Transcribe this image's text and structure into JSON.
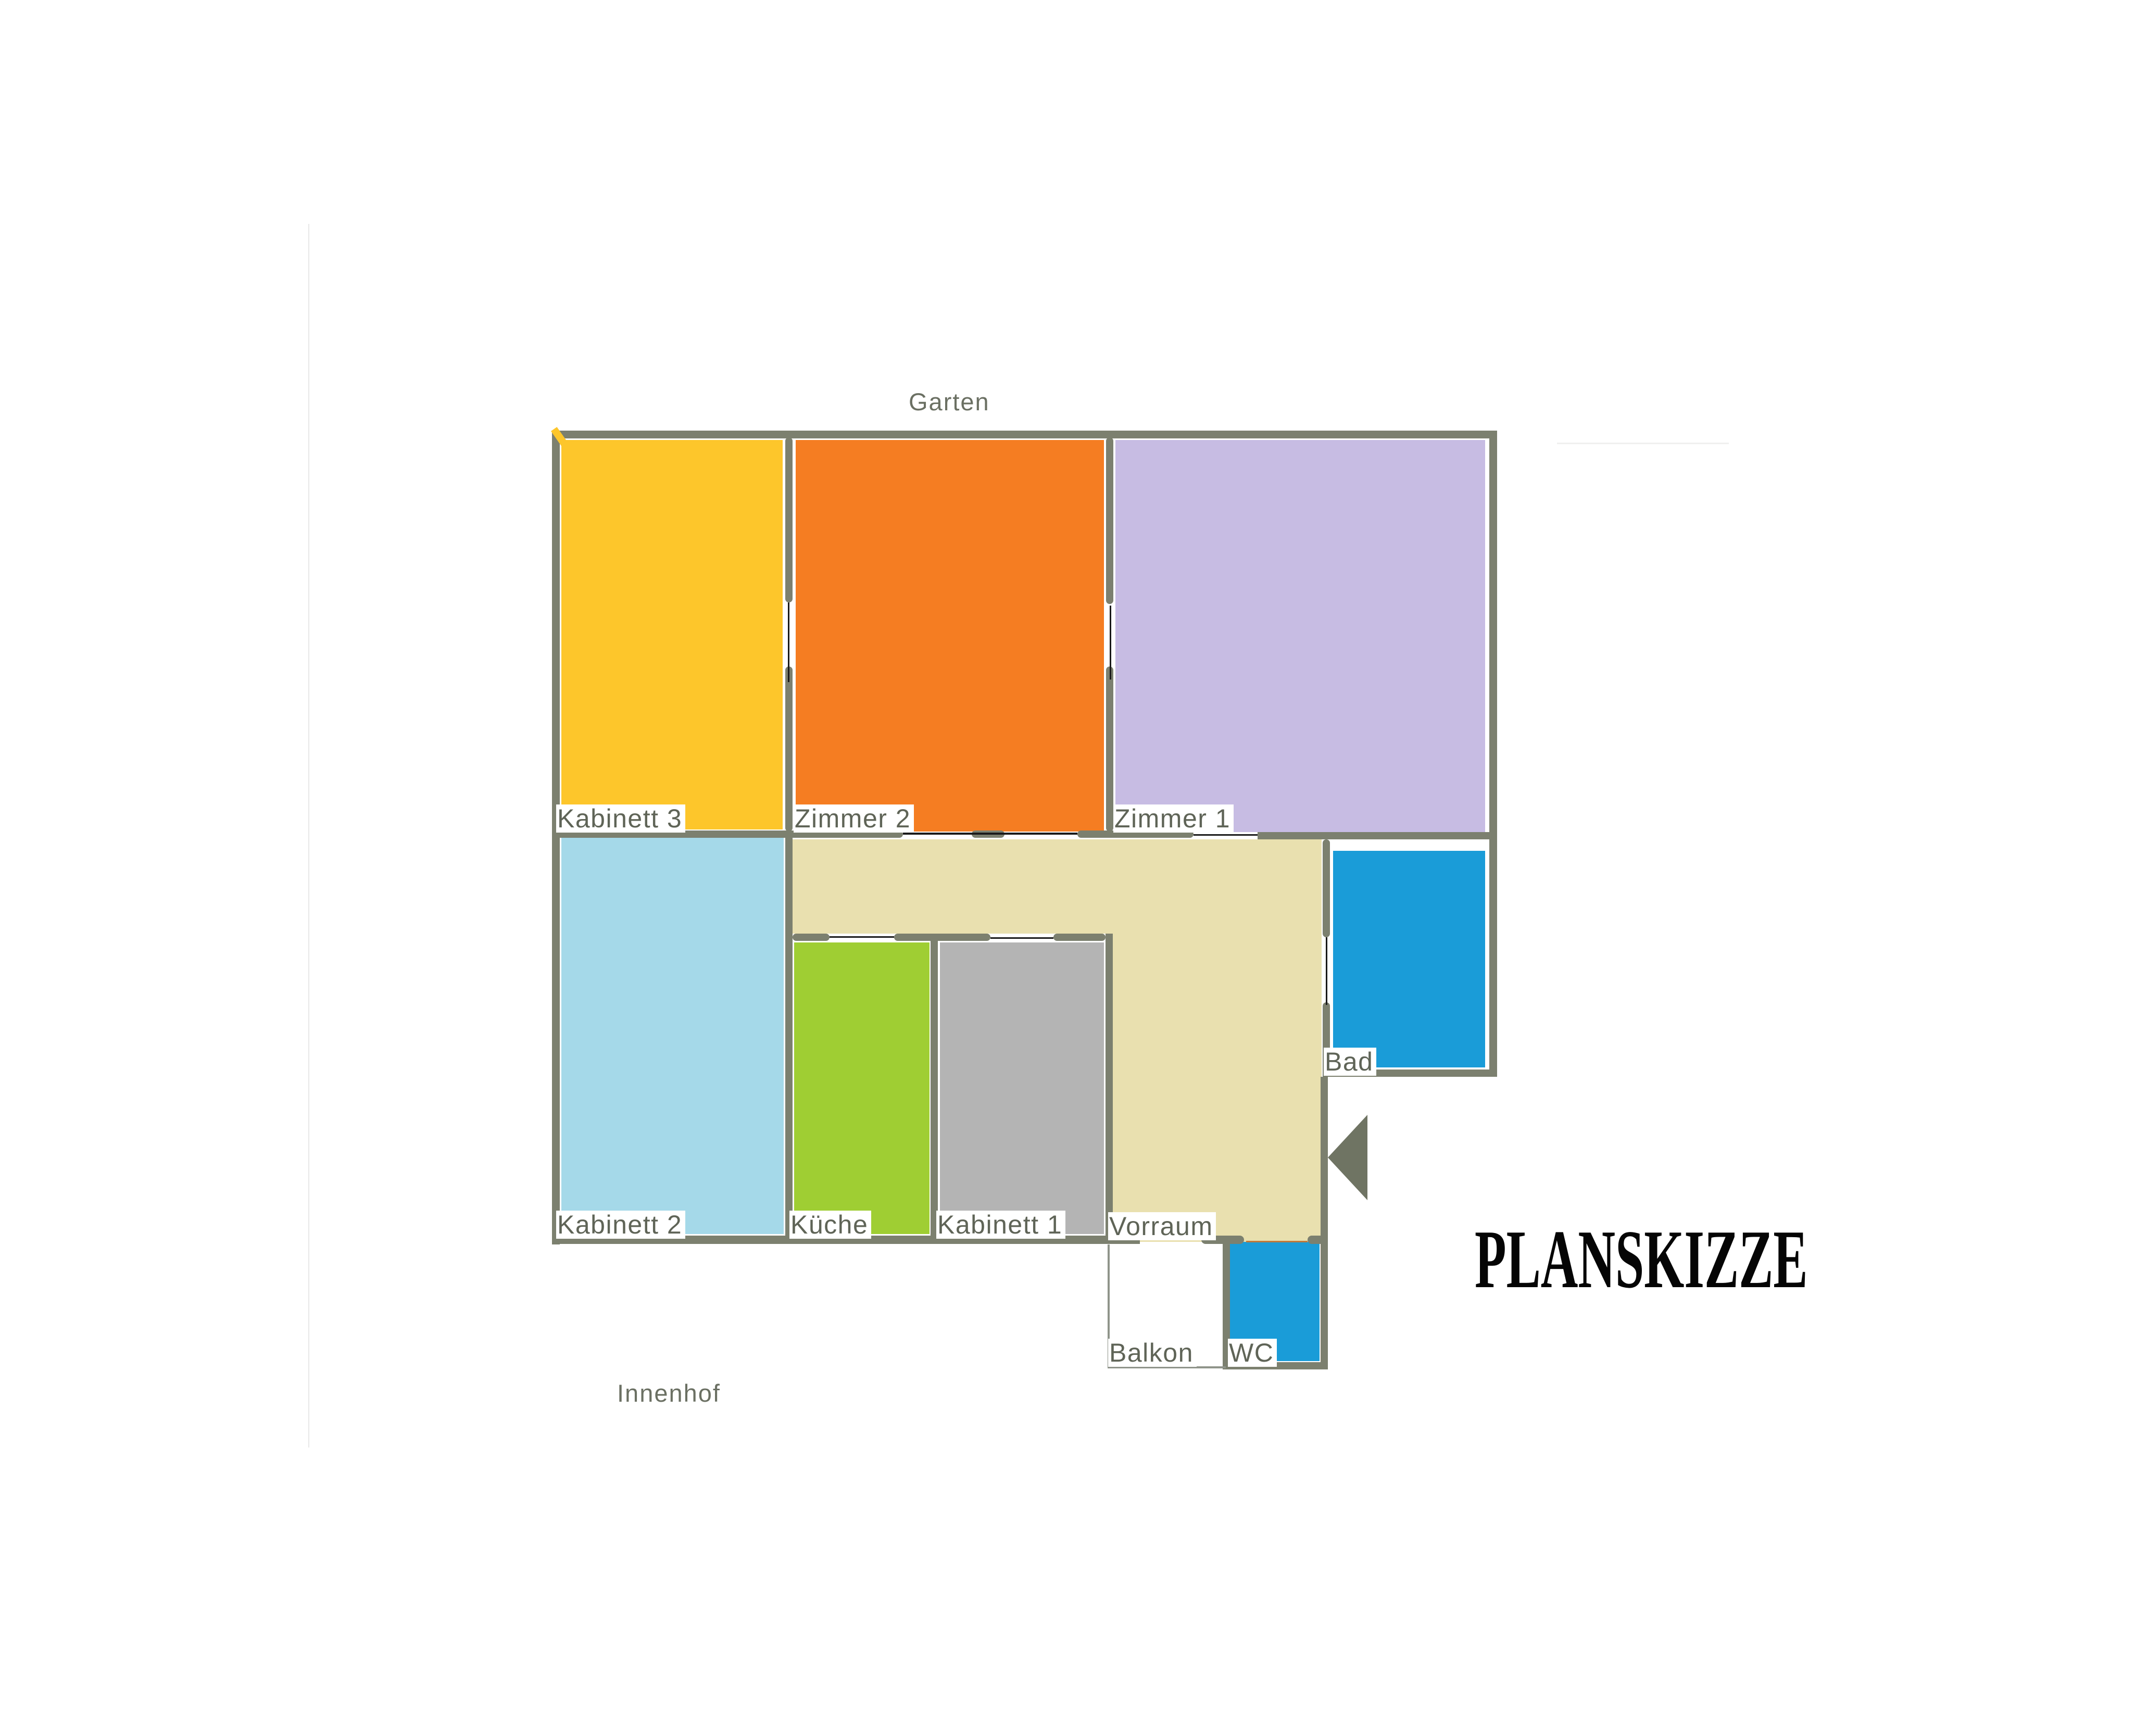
{
  "title": "PLANSKIZZE",
  "outside": {
    "garden_label": "Garten",
    "courtyard_label": "Innenhof"
  },
  "rooms": {
    "kabinett3": {
      "label": "Kabinett 3",
      "color": "#fdc62b"
    },
    "zimmer2": {
      "label": "Zimmer 2",
      "color": "#f57d22"
    },
    "zimmer1": {
      "label": "Zimmer 1",
      "color": "#c7bce3"
    },
    "kabinett2": {
      "label": "Kabinett 2",
      "color": "#a5d9e9"
    },
    "kueche": {
      "label": "Küche",
      "color": "#9fce33"
    },
    "kabinett1": {
      "label": "Kabinett 1",
      "color": "#b4b4b4"
    },
    "vorraum": {
      "label": "Vorraum",
      "color": "#e9e0af"
    },
    "bad": {
      "label": "Bad",
      "color": "#1a9cd8"
    },
    "wc": {
      "label": "WC",
      "color": "#1a9cd8"
    },
    "balkon": {
      "label": "Balkon",
      "color": "#ffffff"
    }
  },
  "colors": {
    "wall": "#7c806f",
    "door_line": "#1a1a1a",
    "wc_door_line": "#c4methodologies",
    "label_text": "#5f6457",
    "title_text": "#050505",
    "entrance_arrow": "#6f7463"
  }
}
